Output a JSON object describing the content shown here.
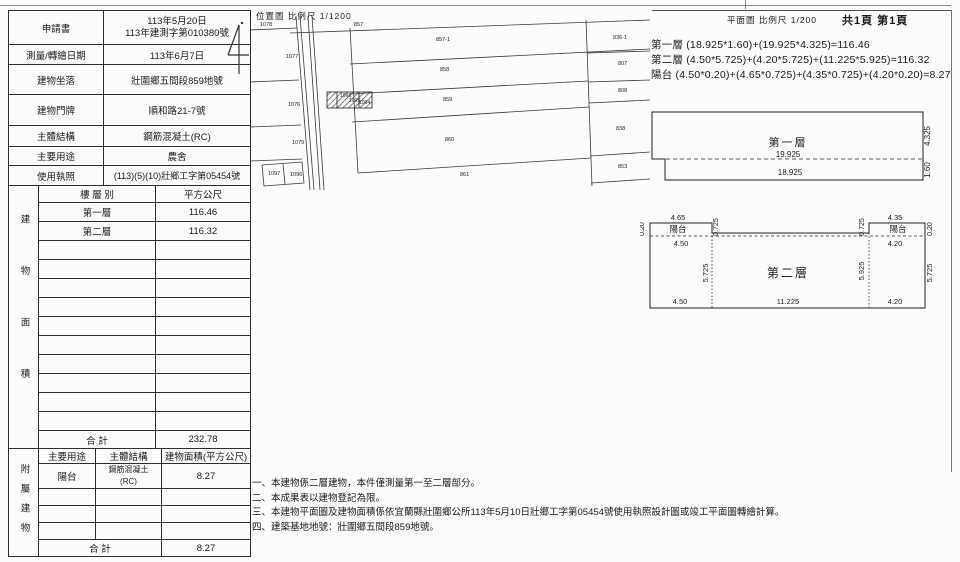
{
  "info": {
    "rows": [
      {
        "label": "申請書",
        "value": "113年5月20日\n113年建測字第010380號"
      },
      {
        "label": "測量/轉繪日期",
        "value": "113年6月7日"
      },
      {
        "label": "建物坐落",
        "value": "壯圍鄉五間段859地號"
      },
      {
        "label": "建物門牌",
        "value": "順和路21-7號"
      },
      {
        "label": "主體結構",
        "value": "鋼筋混凝土(RC)"
      },
      {
        "label": "主要用途",
        "value": "農舍"
      },
      {
        "label": "使用執照",
        "value": "(113)(5)(10)壯鄉工字第05454號"
      }
    ]
  },
  "building_area": {
    "side_label": "建物面積",
    "header": {
      "floor": "樓 層 別",
      "sqm": "平方公尺"
    },
    "rows": [
      {
        "floor": "第一層",
        "sqm": "116.46"
      },
      {
        "floor": "第二層",
        "sqm": "116.32"
      }
    ],
    "total_label": "合  計",
    "total": "232.78"
  },
  "annex": {
    "side_label": "附屬建物",
    "header": {
      "use": "主要用途",
      "structure": "主體結構",
      "area": "建物面積(平方公尺)"
    },
    "rows": [
      {
        "use": "陽台",
        "structure": "鋼筋混凝土\n(RC)",
        "area": "8.27"
      }
    ],
    "total_label": "合  計",
    "total": "8.27"
  },
  "map": {
    "title": "位置圖 比例尺  1/1200",
    "parcels": {
      "left": [
        "1078",
        "1077",
        "1076",
        "1079",
        "1097",
        "1096"
      ],
      "road": [
        "1098",
        "1095",
        "1094"
      ],
      "strips": [
        "857",
        "857-1",
        "858",
        "859",
        "860",
        "861"
      ],
      "right": [
        "836-1",
        "807",
        "808",
        "838",
        "853"
      ]
    }
  },
  "plans": {
    "header": "平面圖 比例尺  1/200",
    "page_info": "共1頁 第1頁",
    "formulas": [
      "第一層 (18.925*1.60)+(19.925*4.325)=116.46",
      "第二層 (4.50*5.725)+(4.20*5.725)+(11.225*5.925)=116.32",
      "陽台 (4.50*0.20)+(4.65*0.725)+(4.35*0.725)+(4.20*0.20)=8.27"
    ],
    "first_floor": {
      "label": "第一層",
      "w_top": "19.925",
      "w_bottom": "18.925",
      "h_main": "4.325",
      "h_strip": "1.60"
    },
    "second_floor": {
      "label": "第二層",
      "balcony": "陽台",
      "lb_top": "4.65",
      "lb_bottom": "4.50",
      "lb_depth": "0.725",
      "rb_top": "4.35",
      "rb_bottom": "4.20",
      "rb_depth": "0.725",
      "l_edge": "0.20",
      "r_edge": "0.20",
      "h_left": "5.725",
      "h_center": "5.925",
      "h_right": "5.725",
      "b_left": "4.50",
      "b_center": "11.225",
      "b_right": "4.20"
    }
  },
  "notes": [
    "一、本建物係二層建物，本件僅測量第一至二層部分。",
    "二、本成果表以建物登記為限。",
    "三、本建物平面圖及建物面積係依宜蘭縣壯圍鄉公所113年5月10日壯鄉工字第05454號使用執照設計圖或竣工平面圖轉繪計算。",
    "四、建築基地地號：壯圍鄉五間段859地號。"
  ]
}
